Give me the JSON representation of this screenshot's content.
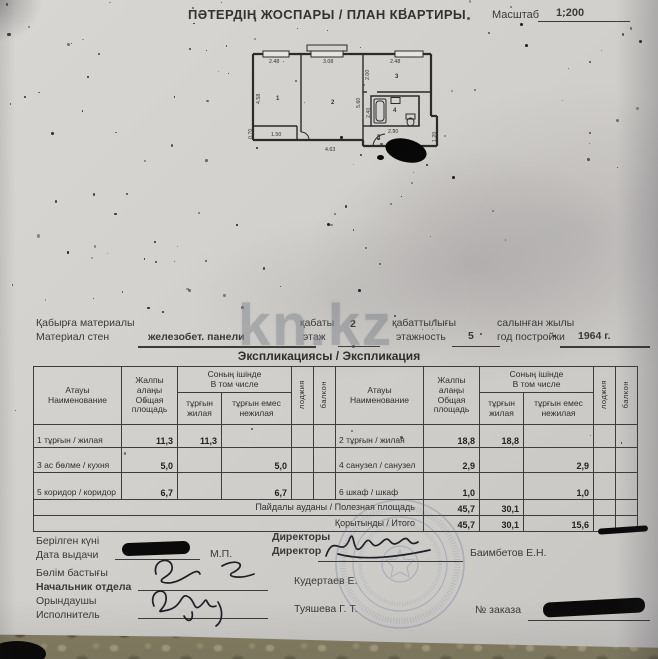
{
  "colors": {
    "paper": "#d3d1cd",
    "ink": "#3a3a3a",
    "stamp_blue": "#6b7b9d",
    "watermark_gray": "#878c92",
    "redaction": "#0a0a0a"
  },
  "header": {
    "title": "ПӘТЕРДІҢ ЖОСПАРЫ / ПЛАН КВАРТИРЫ",
    "scale_label": "Масштаб",
    "scale_value": "1:200"
  },
  "watermark": "kn.kz",
  "plan": {
    "dims": {
      "top1": "2.48",
      "top2": "3.08",
      "top3": "2.48",
      "left": "4.58",
      "mid": "5.60",
      "kitchen_h": "2.00",
      "bath_h": "2.40",
      "closet_w": "1.50",
      "closet_h": "0.70",
      "bottom1": "4.63",
      "corridor": "2.90",
      "bottom2": "3.78",
      "step": "1.20"
    },
    "rooms": {
      "r1": "1",
      "r2": "2",
      "r3": "3",
      "r4": "4",
      "r5": "5"
    }
  },
  "info": {
    "wall_kk": "Қабырға материалы",
    "wall_ru": "Материал стен",
    "wall_value": "железобет. панели",
    "floor_kk": "қабаты",
    "floor_ru": "этаж",
    "floor_value": "2",
    "floors_kk": "қабаттылығы",
    "floors_ru": "этажность",
    "floors_value": "5",
    "year_kk": "салынған жылы",
    "year_ru": "год постройки",
    "year_value": "1964 г."
  },
  "section_title": "Экспликациясы / Экспликация",
  "table": {
    "head": {
      "name_kk": "Атауы",
      "name_ru": "Наименование",
      "total_kk": "Жалпы алаңы",
      "total_ru": "Общая площадь",
      "incl_kk": "Соның ішінде",
      "incl_ru": "В том числе",
      "living_kk": "тұрғын",
      "living_ru": "жилая",
      "nonliving_kk": "тұрғын емес",
      "nonliving_ru": "нежилая",
      "loggia": "лоджия",
      "balcony": "балкон"
    },
    "left_rows": [
      {
        "name": "1 тұрғын / жилая",
        "total": "11,3",
        "living": "11,3",
        "nonliving": ""
      },
      {
        "name": "3 ас бөлме / кухня",
        "total": "5,0",
        "living": "",
        "nonliving": "5,0"
      },
      {
        "name": "5 коридор / коридор",
        "total": "6,7",
        "living": "",
        "nonliving": "6,7"
      }
    ],
    "right_rows": [
      {
        "name": "2 тұрғын / жилая",
        "total": "18,8",
        "living": "18,8",
        "nonliving": ""
      },
      {
        "name": "4 санузел / санузел",
        "total": "2,9",
        "living": "",
        "nonliving": "2,9"
      },
      {
        "name": "6 шкаф / шкаф",
        "total": "1,0",
        "living": "",
        "nonliving": "1,0"
      }
    ],
    "footer": [
      {
        "label": "Пайдалы ауданы / Полезная площадь",
        "total": "45,7",
        "living": "30,1",
        "nonliving": ""
      },
      {
        "label": "Қорытынды / Итого",
        "total": "45,7",
        "living": "30,1",
        "nonliving": "15,6"
      }
    ]
  },
  "signatures": {
    "issued_kk": "Берілген күні",
    "issued_ru": "Дата выдачи",
    "mp": "М.П.",
    "director_kk": "Директоры",
    "director_ru": "Директор",
    "director_name": "Баимбетов Е.Н.",
    "head_kk": "Бөлім бастығы",
    "head_ru": "Начальник отдела",
    "head_name": "Кудертаев Е.",
    "exec_kk": "Орындаушы",
    "exec_ru": "Исполнитель",
    "exec_name": "Туяшева Г. Т.",
    "order_label": "№ заказа"
  }
}
